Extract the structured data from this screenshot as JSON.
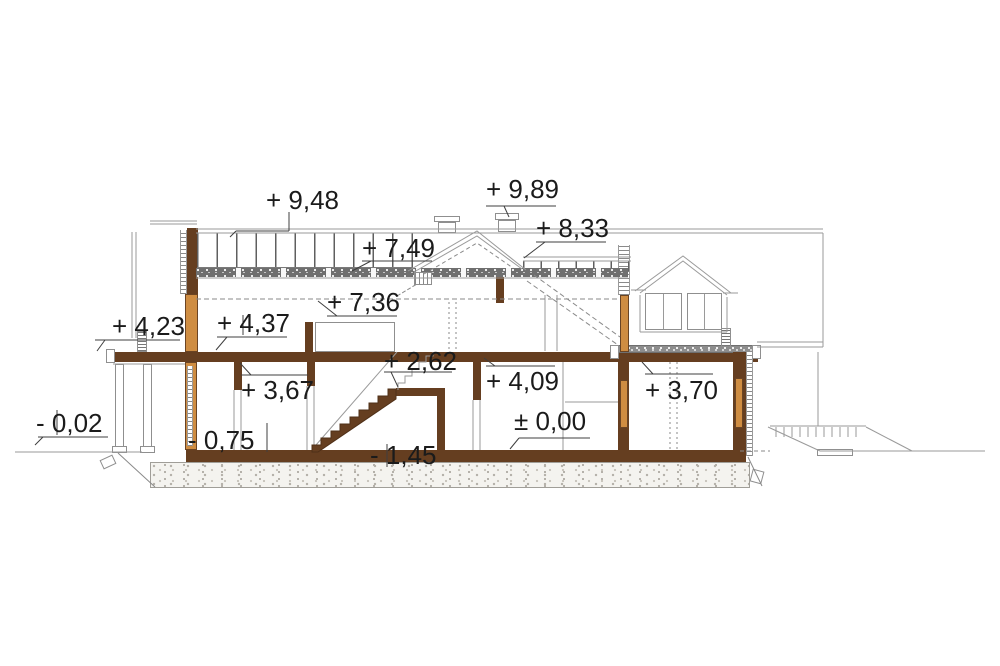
{
  "drawing": {
    "kind": "house cross-section (przekrój)",
    "unit": "m"
  },
  "labels": [
    {
      "id": "roof-left-top",
      "text": "+ 9,48"
    },
    {
      "id": "chimney-top",
      "text": "+ 9,89"
    },
    {
      "id": "roof-right-top",
      "text": "+ 8,33"
    },
    {
      "id": "roof-underside",
      "text": "+ 7,49"
    },
    {
      "id": "attic-ceiling",
      "text": "+ 7,36"
    },
    {
      "id": "porch-roof-level",
      "text": "+ 4,23"
    },
    {
      "id": "attic-floor-left",
      "text": "+ 4,37"
    },
    {
      "id": "stair-landing",
      "text": "+ 2,62"
    },
    {
      "id": "ceiling-left",
      "text": "+ 3,67"
    },
    {
      "id": "ceiling-right",
      "text": "+ 4,09"
    },
    {
      "id": "terrace-level",
      "text": "+ 3,70"
    },
    {
      "id": "ground-floor-level",
      "text": "± 0,00"
    },
    {
      "id": "sunken-floor-level",
      "text": "- 0,75"
    },
    {
      "id": "foundation-level",
      "text": "- 1,45"
    },
    {
      "id": "exterior-grade",
      "text": "- 0,02"
    }
  ],
  "colors": {
    "wall_section_brown": "#653e20",
    "wood_frame_orange": "#cf8d42",
    "insulation_gray": "#6f6f6f",
    "line_gray": "#8f8f8f",
    "text": "#1b1b1b",
    "background": "#ffffff"
  }
}
